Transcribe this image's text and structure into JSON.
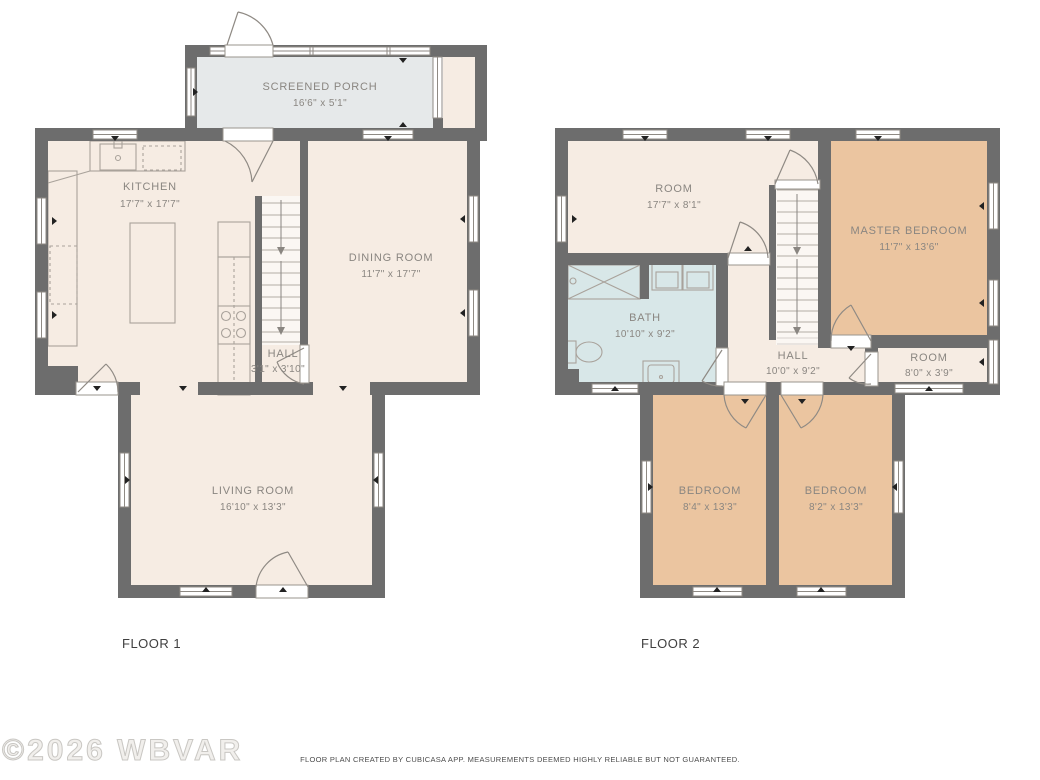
{
  "floor1": {
    "label": "FLOOR 1",
    "rooms": {
      "screened_porch": {
        "name": "SCREENED PORCH",
        "dims": "16'6\" x 5'1\""
      },
      "kitchen": {
        "name": "KITCHEN",
        "dims": "17'7\" x 17'7\""
      },
      "dining_room": {
        "name": "DINING ROOM",
        "dims": "11'7\" x 17'7\""
      },
      "hall": {
        "name": "HALL",
        "dims": "3'1\" x 3'10\""
      },
      "living_room": {
        "name": "LIVING ROOM",
        "dims": "16'10\" x 13'3\""
      }
    }
  },
  "floor2": {
    "label": "FLOOR 2",
    "rooms": {
      "room_top": {
        "name": "ROOM",
        "dims": "17'7\" x 8'1\""
      },
      "master_bedroom": {
        "name": "MASTER BEDROOM",
        "dims": "11'7\" x 13'6\""
      },
      "bath": {
        "name": "BATH",
        "dims": "10'10\" x 9'2\""
      },
      "hall": {
        "name": "HALL",
        "dims": "10'0\" x 9'2\""
      },
      "room_small": {
        "name": "ROOM",
        "dims": "8'0\" x 3'9\""
      },
      "bedroom_left": {
        "name": "BEDROOM",
        "dims": "8'4\" x 13'3\""
      },
      "bedroom_right": {
        "name": "BEDROOM",
        "dims": "8'2\" x 13'3\""
      }
    }
  },
  "watermark": "©2026 WBVAR",
  "footer": "FLOOR PLAN CREATED BY CUBICASA APP. MEASUREMENTS DEEMED HIGHLY RELIABLE BUT NOT GUARANTEED.",
  "colors": {
    "wall": "#6d6d6d",
    "floor": "#f6ece3",
    "porch": "#e6e9ea",
    "bath": "#d8e7e8",
    "bedroom": "#ebc5a0",
    "stairwell": "#fbf7f3",
    "label_text": "#8a8681",
    "floor_label_text": "#3f3f3f",
    "footer_text": "#4c4c4c"
  }
}
